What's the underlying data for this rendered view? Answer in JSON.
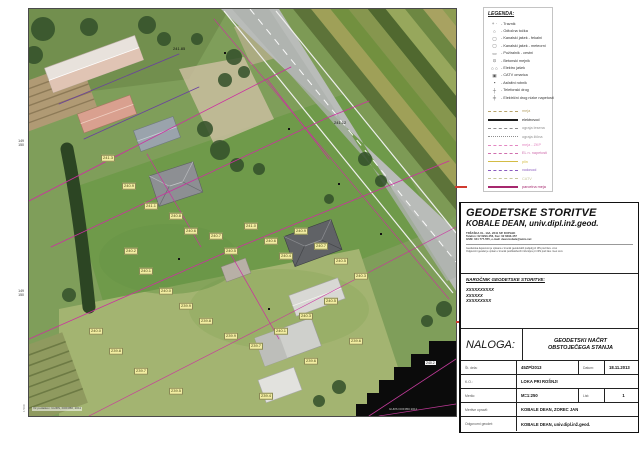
{
  "legend": {
    "title": "LEGENDA:",
    "symbols": [
      {
        "icon": "plus-dot-symbol",
        "glyph": "+ ·",
        "label": "Travnik"
      },
      {
        "icon": "circle-symbol",
        "glyph": "○",
        "label": "Odtočna točka"
      },
      {
        "icon": "square-symbol",
        "glyph": "▢",
        "label": "Kanalski jašek - fekalni"
      },
      {
        "icon": "square-symbol",
        "glyph": "▢",
        "label": "Kanalski jašek - meteorni"
      },
      {
        "icon": "grate-symbol",
        "glyph": "▭",
        "label": "Požiralnik - cestni"
      },
      {
        "icon": "marker-symbol",
        "glyph": "⊙",
        "label": "Betonski mejnik"
      },
      {
        "icon": "double-circle-symbol",
        "glyph": "○ ○",
        "label": "Elektro jašek"
      },
      {
        "icon": "cabinet-symbol",
        "glyph": "▣",
        "label": "CATV omarica"
      },
      {
        "icon": "filled-square-symbol",
        "glyph": "▪",
        "label": "Asfaltni robnik"
      },
      {
        "icon": "pole-symbol",
        "glyph": "┼",
        "label": "Telefonski drog"
      },
      {
        "icon": "pole-symbol",
        "glyph": "╪",
        "label": "Električni drog nizke napetosti"
      }
    ],
    "lines": [
      {
        "label": "meja",
        "color": "#b8a36a",
        "style": "dashed",
        "weight": 1
      },
      {
        "label": "elektrovod",
        "color": "#1c1c1c",
        "style": "solid",
        "weight": 2
      },
      {
        "label": "ograja lesena",
        "color": "#8f8f8f",
        "style": "dashed",
        "weight": 1
      },
      {
        "label": "ograja žična",
        "color": "#8f8f8f",
        "style": "dotted",
        "weight": 1
      },
      {
        "label": "meja - ZKP",
        "color": "#e387c2",
        "style": "dashed",
        "weight": 1
      },
      {
        "label": "EL n. napetosti",
        "color": "#d06fae",
        "style": "dashed",
        "weight": 1
      },
      {
        "label": "plin",
        "color": "#d3bc45",
        "style": "solid",
        "weight": 1
      },
      {
        "label": "vodovod",
        "color": "#8a5bbf",
        "style": "dashed",
        "weight": 1
      },
      {
        "label": "CATV",
        "color": "#c6c69b",
        "style": "dashed",
        "weight": 1
      },
      {
        "label": "parcelna meja",
        "color": "#a6286e",
        "style": "solid",
        "weight": 2
      }
    ]
  },
  "firm": {
    "name_line1": "GEODETSKE STORITVE",
    "name_line2": "KOBALE DEAN, univ.dipl.inž.geod.",
    "address_lines": [
      "TRŽAŠKA UL. 14A, 2241 SP. DUPLEK",
      "Telefon: 02 6293-456, Fax: 02 6293-457",
      "GSM: 041 777-555, e-mail: dean.kobale@amis.net"
    ],
    "fine_print_lines": [
      "Geodetska dejavnost je vpisana v imenik geodetskih podjetij pri IZS pod štev. xxxx",
      "Odgovorni geodet je vpisan v imenik pooblaščenih inženirjev pri IZS pod štev. Geo xxxx"
    ]
  },
  "client": {
    "heading": "NAROČNIK GEODETSKE STORITVE:",
    "lines": [
      "XXXXXXXXXX",
      "XXXXXX",
      "XXXXXXXXX"
    ]
  },
  "task": {
    "naloga_label": "NALOGA:",
    "title_line1": "GEODETSKI NAČRT",
    "title_line2": "OBSTOJEČEGA STANJA",
    "rows": {
      "st_dela_label": "Št. dela:",
      "st_dela_value": "45ZP/2013",
      "datum_label": "Datum:",
      "datum_value": "18.11.2013",
      "ko_label": "K.O.:",
      "ko_value": "LOKA PRI ROŠNJI",
      "merilo_label": "Merilo:",
      "merilo_value": "M=1:250",
      "list_label": "List:",
      "list_value": "1",
      "meritve_label": "Meritve opravil:",
      "meritve_value": "KOBALE DEAN, ZOREC JAN",
      "geodet_label": "Odgovorni geodet:",
      "geodet_value": "KOBALE DEAN, univ.dipl.inž.geod."
    }
  },
  "map": {
    "margin_labels": [
      {
        "lines": [
          "149",
          "150"
        ],
        "x": 8,
        "y": 140
      },
      {
        "lines": [
          "149",
          "150"
        ],
        "x": 8,
        "y": 290
      }
    ],
    "scale_note": "1:500",
    "source_note": "Vir podatkov: GURS, DOF050, 2011",
    "corner_note": "GURS DOF050 2011",
    "road_labels": [
      {
        "text": "241.85",
        "x": 144,
        "y": 38
      },
      {
        "text": "241.12",
        "x": 305,
        "y": 112
      }
    ],
    "white_labels": [
      {
        "text": "240.2",
        "x": 396,
        "y": 352
      }
    ],
    "spot_labels": [
      {
        "t": "241.3",
        "x": 79,
        "y": 149
      },
      {
        "t": "240.9",
        "x": 100,
        "y": 177
      },
      {
        "t": "241.1",
        "x": 122,
        "y": 197
      },
      {
        "t": "240.8",
        "x": 147,
        "y": 207
      },
      {
        "t": "240.6",
        "x": 162,
        "y": 222
      },
      {
        "t": "240.7",
        "x": 187,
        "y": 227
      },
      {
        "t": "240.5",
        "x": 202,
        "y": 242
      },
      {
        "t": "241.0",
        "x": 222,
        "y": 217
      },
      {
        "t": "240.6",
        "x": 242,
        "y": 232
      },
      {
        "t": "240.4",
        "x": 257,
        "y": 247
      },
      {
        "t": "240.9",
        "x": 272,
        "y": 222
      },
      {
        "t": "240.7",
        "x": 292,
        "y": 237
      },
      {
        "t": "240.5",
        "x": 312,
        "y": 252
      },
      {
        "t": "240.3",
        "x": 332,
        "y": 267
      },
      {
        "t": "240.2",
        "x": 102,
        "y": 242
      },
      {
        "t": "240.1",
        "x": 117,
        "y": 262
      },
      {
        "t": "240.0",
        "x": 137,
        "y": 282
      },
      {
        "t": "239.9",
        "x": 157,
        "y": 297
      },
      {
        "t": "239.8",
        "x": 177,
        "y": 312
      },
      {
        "t": "239.9",
        "x": 202,
        "y": 327
      },
      {
        "t": "239.7",
        "x": 227,
        "y": 337
      },
      {
        "t": "240.1",
        "x": 252,
        "y": 322
      },
      {
        "t": "240.3",
        "x": 277,
        "y": 307
      },
      {
        "t": "240.5",
        "x": 302,
        "y": 292
      },
      {
        "t": "239.6",
        "x": 327,
        "y": 332
      },
      {
        "t": "240.0",
        "x": 67,
        "y": 322
      },
      {
        "t": "239.8",
        "x": 87,
        "y": 342
      },
      {
        "t": "239.7",
        "x": 112,
        "y": 362
      },
      {
        "t": "239.5",
        "x": 147,
        "y": 382
      },
      {
        "t": "239.4",
        "x": 237,
        "y": 387
      },
      {
        "t": "239.6",
        "x": 282,
        "y": 352
      }
    ]
  }
}
